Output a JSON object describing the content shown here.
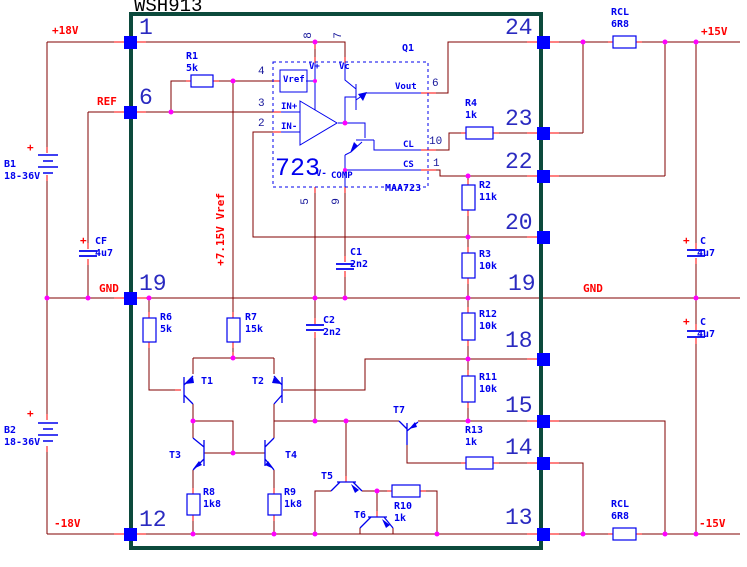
{
  "window": {
    "title": "WSH913"
  },
  "power": {
    "p18v": "+18V",
    "n18v": "-18V",
    "p15v": "+15V",
    "n15v": "-15V",
    "gnd_left": "GND",
    "gnd_right": "GND",
    "ref": "REF",
    "vref_line": "+7.15V Vref"
  },
  "sources": {
    "b1": {
      "name": "B1",
      "value": "18-36V",
      "plus": "+"
    },
    "b2": {
      "name": "B2",
      "value": "18-36V",
      "plus": "+"
    }
  },
  "ic": {
    "label": "Q1",
    "big": "723",
    "part": "MAA723",
    "pins": {
      "vref": "Vref",
      "vplus": "V+",
      "vc": "Vc",
      "inp": "IN+",
      "inn": "IN-",
      "vminus": "V-",
      "comp": "COMP",
      "vout": "Vout",
      "cl": "CL",
      "cs": "CS"
    },
    "pin_numbers": {
      "n4": "4",
      "n3": "3",
      "n2": "2",
      "n8": "8",
      "n7": "7",
      "n5": "5",
      "n9": "9",
      "n6": "6",
      "n10": "10",
      "n1": "1"
    }
  },
  "package_pins": {
    "left": [
      "1",
      "6",
      "19",
      "12"
    ],
    "right": [
      "24",
      "23",
      "22",
      "20",
      "19",
      "18",
      "15",
      "14",
      "13"
    ]
  },
  "resistors": {
    "r1": {
      "name": "R1",
      "value": "5k"
    },
    "r2": {
      "name": "R2",
      "value": "11k"
    },
    "r3": {
      "name": "R3",
      "value": "10k"
    },
    "r4": {
      "name": "R4",
      "value": "1k"
    },
    "r6": {
      "name": "R6",
      "value": "5k"
    },
    "r7": {
      "name": "R7",
      "value": "15k"
    },
    "r8": {
      "name": "R8",
      "value": "1k8"
    },
    "r9": {
      "name": "R9",
      "value": "1k8"
    },
    "r10": {
      "name": "R10",
      "value": "1k"
    },
    "r11": {
      "name": "R11",
      "value": "10k"
    },
    "r12": {
      "name": "R12",
      "value": "10k"
    },
    "r13": {
      "name": "R13",
      "value": "1k"
    },
    "rcl_top": {
      "name": "RCL",
      "value": "6R8"
    },
    "rcl_bottom": {
      "name": "RCL",
      "value": "6R8"
    }
  },
  "capacitors": {
    "c1": {
      "name": "C1",
      "value": "2n2"
    },
    "c2": {
      "name": "C2",
      "value": "2n2"
    },
    "cf": {
      "name": "CF",
      "value": "4u7",
      "plus": "+"
    },
    "c_top": {
      "name": "C",
      "value": "4u7",
      "plus": "+"
    },
    "c_bottom": {
      "name": "C",
      "value": "4u7",
      "plus": "+"
    }
  },
  "transistors": {
    "t1": "T1",
    "t2": "T2",
    "t3": "T3",
    "t4": "T4",
    "t5": "T5",
    "t6": "T6",
    "t7": "T7"
  },
  "colors": {
    "wire": "#800000",
    "lead": "#ff0000",
    "symbol": "#0000ee",
    "junction": "#ff00ff",
    "ic_border": "#0c4a3c",
    "net_label": "#ff0000"
  }
}
